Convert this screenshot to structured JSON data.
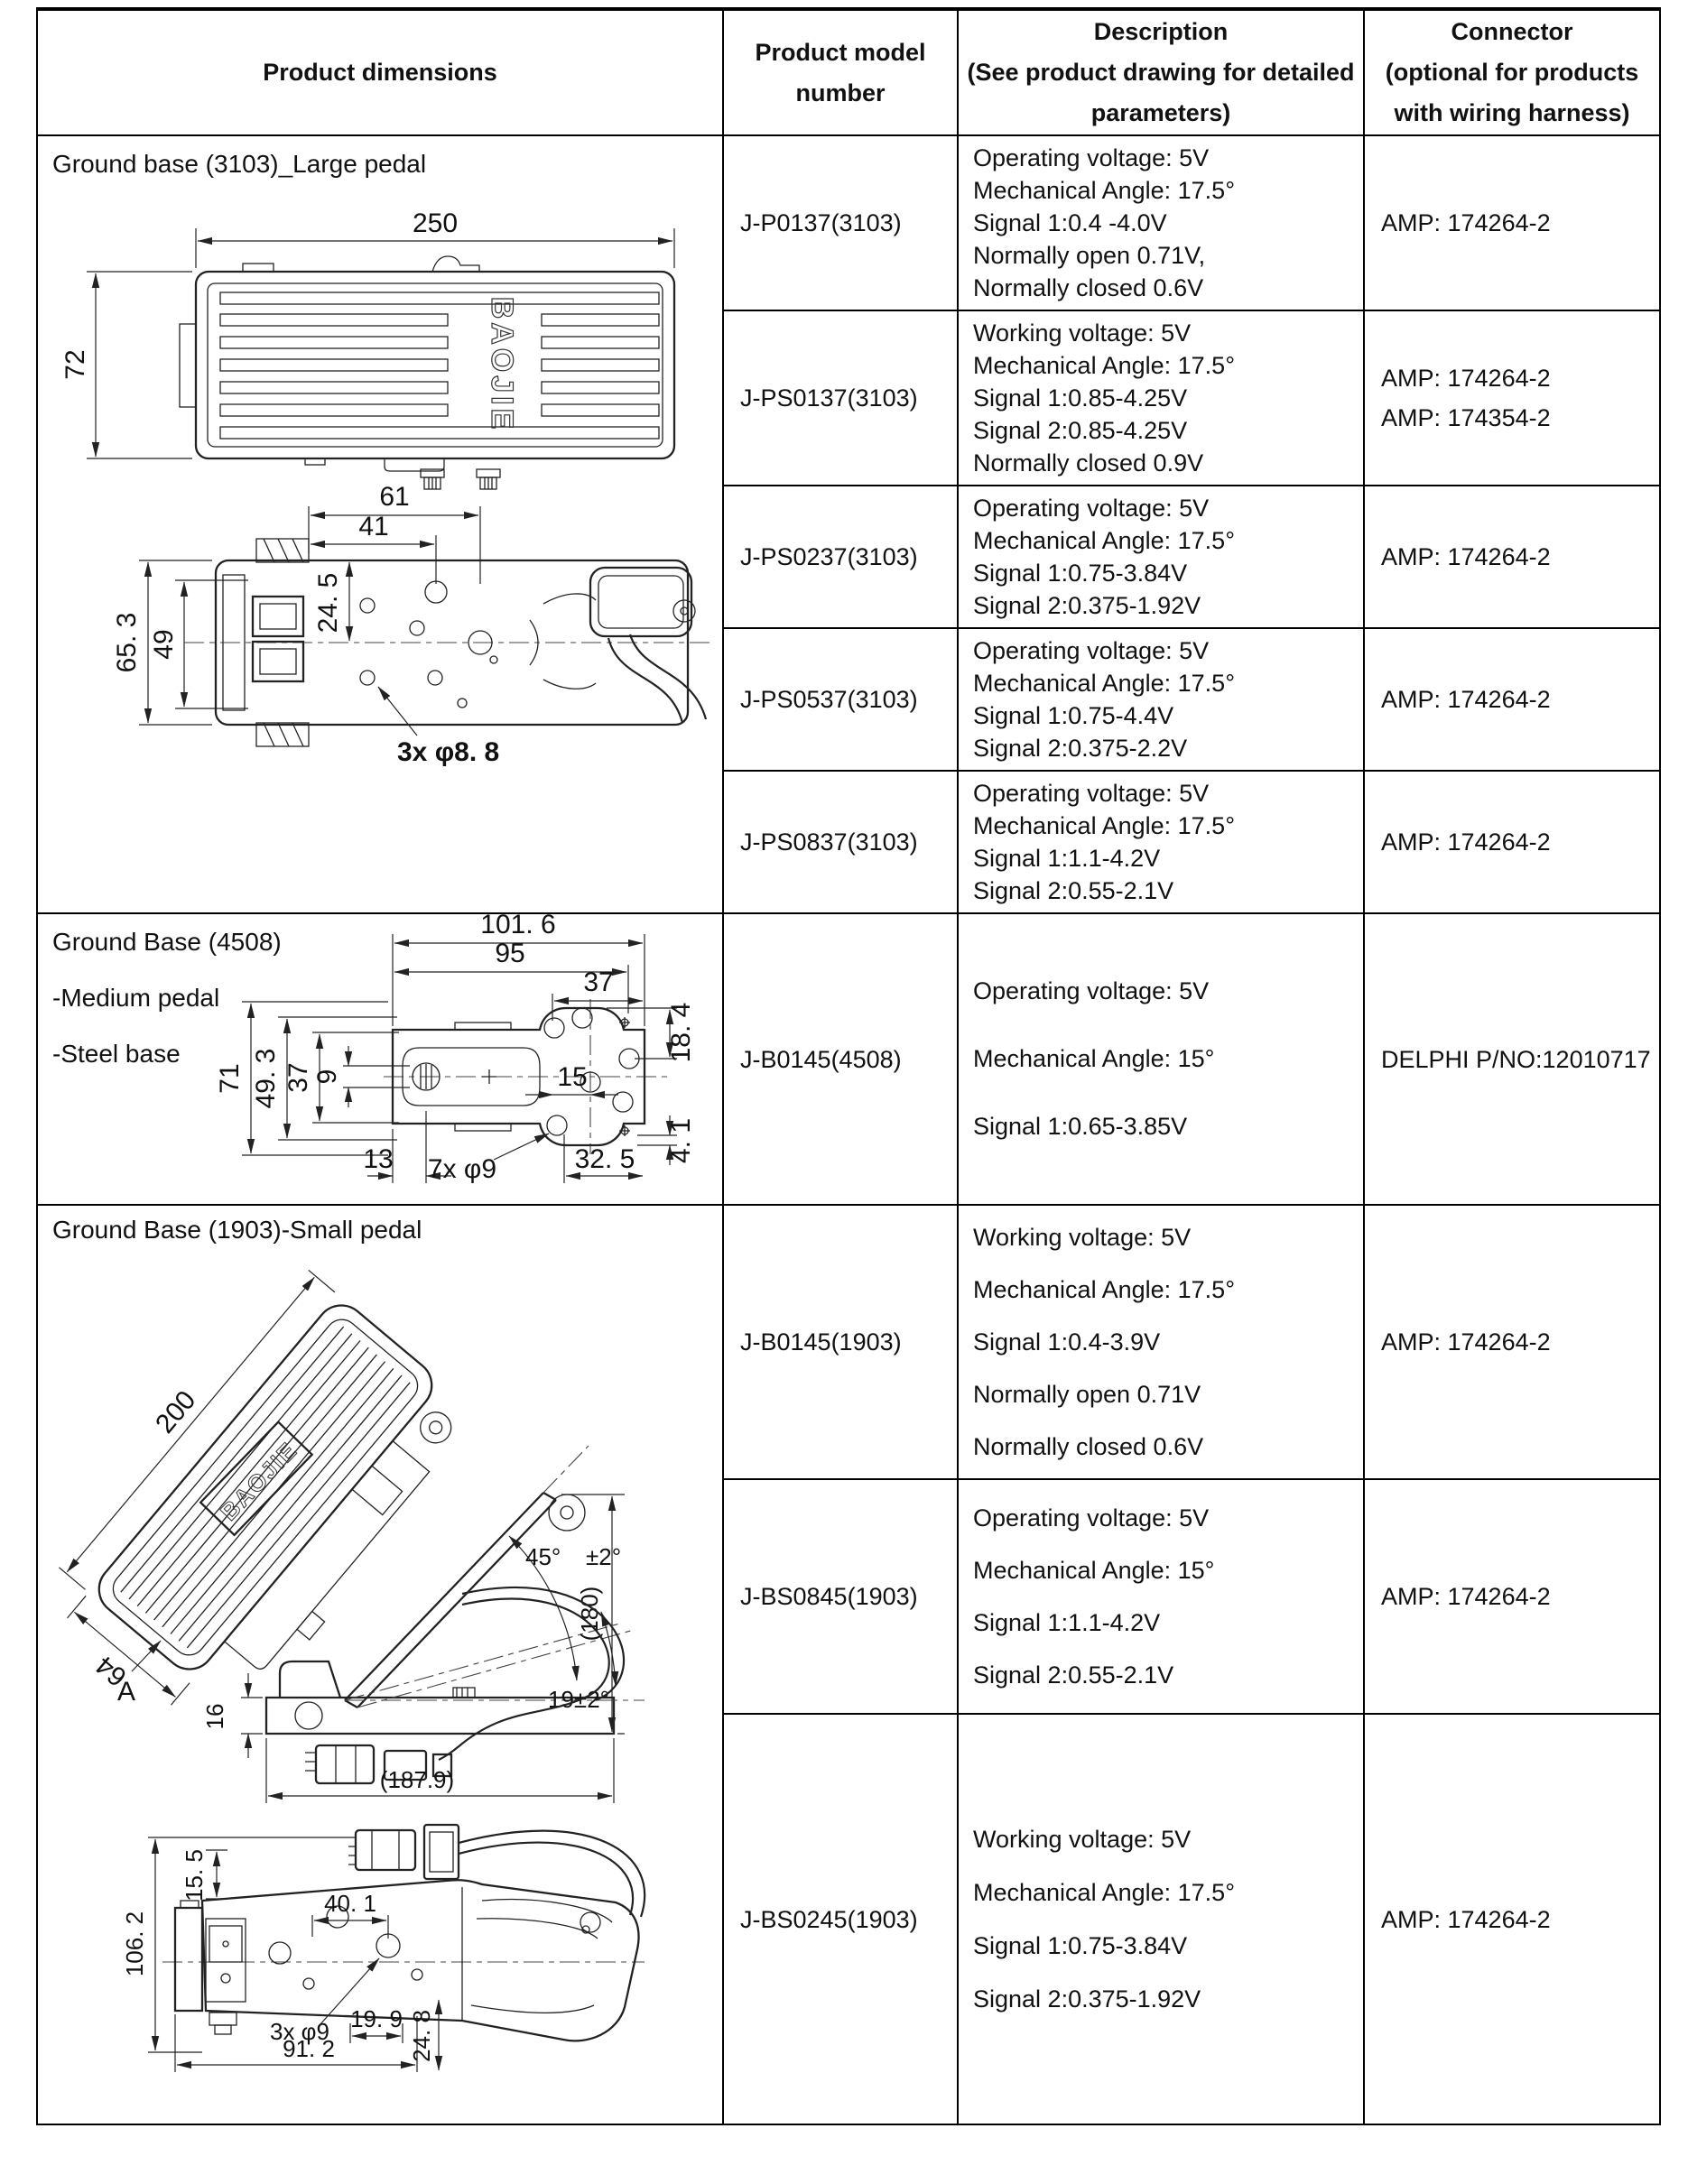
{
  "header": {
    "product_dimensions": "Product dimensions",
    "model": [
      "Product model",
      "number"
    ],
    "description": [
      "Description",
      "(See product drawing for detailed",
      "parameters)"
    ],
    "connector": [
      "Connector",
      "(optional for products",
      "with wiring harness)"
    ]
  },
  "sections": [
    {
      "title_lines": [
        "Ground base (3103)_Large pedal"
      ],
      "rows": [
        {
          "model": "J-P0137(3103)",
          "description": [
            "Operating voltage: 5V",
            "Mechanical Angle: 17.5°",
            "Signal 1:0.4 -4.0V",
            "Normally open 0.71V,",
            "Normally closed 0.6V"
          ],
          "connector": [
            "AMP: 174264-2"
          ]
        },
        {
          "model": "J-PS0137(3103)",
          "description": [
            "Working voltage: 5V",
            "Mechanical Angle: 17.5°",
            "Signal 1:0.85-4.25V",
            "Signal 2:0.85-4.25V",
            "Normally closed 0.9V"
          ],
          "connector": [
            "AMP: 174264-2",
            "AMP: 174354-2"
          ]
        },
        {
          "model": "J-PS0237(3103)",
          "description": [
            "Operating voltage: 5V",
            "Mechanical Angle: 17.5°",
            "Signal 1:0.75-3.84V",
            "Signal 2:0.375-1.92V"
          ],
          "connector": [
            "AMP: 174264-2"
          ]
        },
        {
          "model": "J-PS0537(3103)",
          "description": [
            "Operating voltage: 5V",
            "Mechanical Angle: 17.5°",
            "Signal 1:0.75-4.4V",
            "Signal 2:0.375-2.2V"
          ],
          "connector": [
            "AMP: 174264-2"
          ]
        },
        {
          "model": "J-PS0837(3103)",
          "description": [
            "Operating voltage: 5V",
            "Mechanical Angle: 17.5°",
            "Signal 1:1.1-4.2V",
            "Signal 2:0.55-2.1V"
          ],
          "connector": [
            "AMP: 174264-2"
          ]
        }
      ]
    },
    {
      "title_lines": [
        "Ground Base (4508)",
        "-Medium pedal",
        "-Steel base"
      ],
      "rows": [
        {
          "model": "J-B0145(4508)",
          "description": [
            "Operating voltage: 5V",
            "Mechanical Angle: 15°",
            "Signal 1:0.65-3.85V"
          ],
          "connector": [
            "DELPHI P/NO:12010717"
          ]
        }
      ]
    },
    {
      "title_lines": [
        "Ground Base (1903)-Small pedal"
      ],
      "rows": [
        {
          "model": "J-B0145(1903)",
          "description": [
            "Working voltage: 5V",
            "Mechanical Angle: 17.5°",
            "Signal 1:0.4-3.9V",
            "Normally open 0.71V",
            "Normally closed 0.6V"
          ],
          "connector": [
            "AMP: 174264-2"
          ]
        },
        {
          "model": "J-BS0845(1903)",
          "description": [
            "Operating voltage: 5V",
            "Mechanical Angle: 15°",
            "Signal 1:1.1-4.2V",
            "Signal 2:0.55-2.1V"
          ],
          "connector": [
            "AMP: 174264-2"
          ]
        },
        {
          "model": "J-BS0245(1903)",
          "description": [
            "Working voltage: 5V",
            "Mechanical Angle: 17.5°",
            "Signal 1:0.75-3.84V",
            "Signal 2:0.375-1.92V"
          ],
          "connector": [
            "AMP: 174264-2"
          ]
        }
      ]
    }
  ],
  "drawings": {
    "pedal3103_top": {
      "length": "250",
      "height": "72",
      "brand": "BAOJIE"
    },
    "pedal3103_bottom": {
      "w61": "61",
      "w41": "41",
      "h65": "65. 3",
      "h49": "49",
      "h24": "24. 5",
      "holes": "3x φ8. 8"
    },
    "base4508": {
      "w101": "101. 6",
      "w95": "95",
      "w37_top": "37",
      "h18": "18. 4",
      "h71": "71",
      "h49": "49. 3",
      "h37": "37",
      "h9": "9",
      "w15": "15",
      "h4": "4. 1",
      "w13": "13",
      "holes": "7x φ9",
      "w32": "32. 5"
    },
    "pedal1903_iso": {
      "length": "200",
      "width": "64",
      "view_label": "A",
      "brand": "BAOJIE"
    },
    "pedal1903_side": {
      "angle": "45°",
      "tolerance": "±2°",
      "height": "(180)",
      "travel_angle": "19±2°",
      "base_height": "16",
      "length": "(187.9)"
    },
    "pedal1903_bottom": {
      "h106": "106. 2",
      "h15": "15. 5",
      "w40": "40. 1",
      "holes": "3x φ9",
      "w19": "19. 9",
      "w91": "91. 2",
      "h24": "24. 8"
    }
  }
}
